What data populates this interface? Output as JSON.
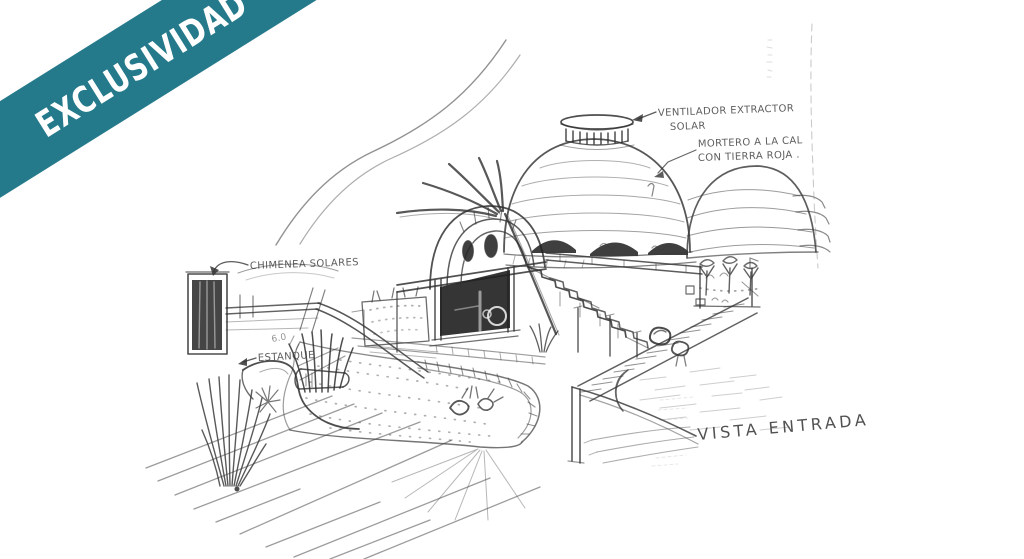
{
  "ribbon": {
    "label": "EXCLUSIVIDAD"
  },
  "colors": {
    "ribbon": "#24798a",
    "ribbon_text": "#ffffff",
    "ink": "#3a3a3a",
    "paper": "#ffffff"
  },
  "annotations": {
    "ventilador_line1": "VENTILADOR EXTRACTOR",
    "ventilador_line2": "SOLAR",
    "mortero_line1": "MORTERO A LA CAL",
    "mortero_line2": "CON TIERRA ROJA .",
    "chimenea": "CHIMENEA SOLARES",
    "estanque": "ESTANQUE",
    "dimension": "6.0",
    "vista": "VISTA ENTRADA"
  }
}
